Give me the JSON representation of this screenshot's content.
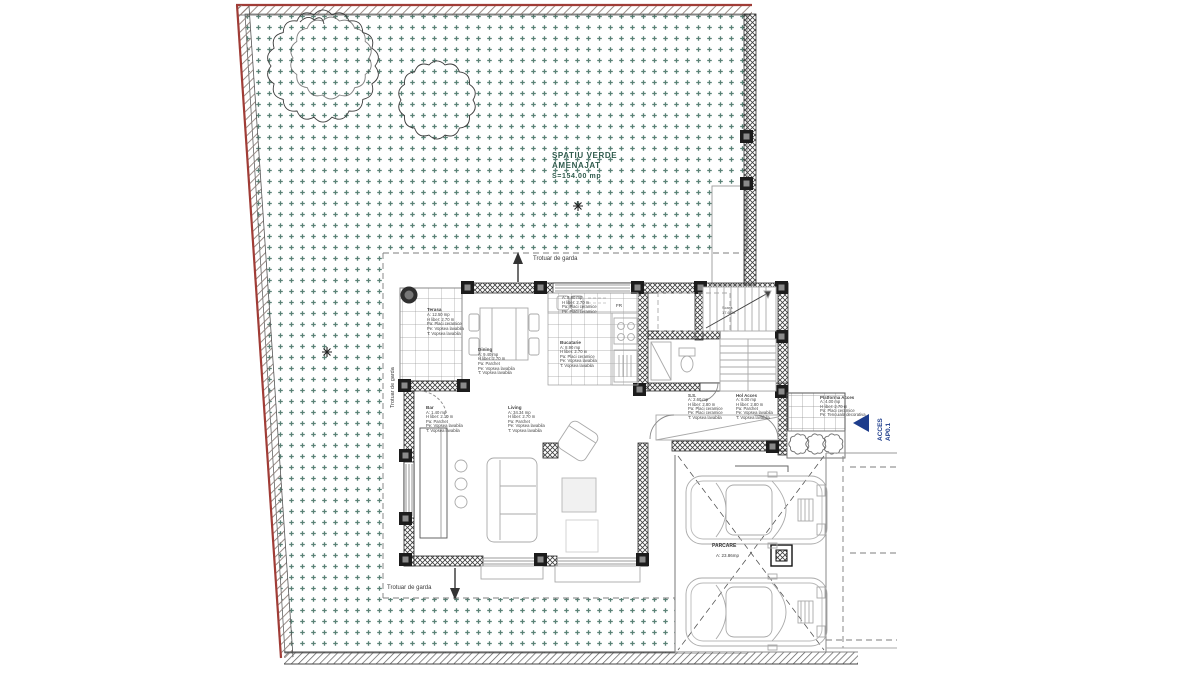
{
  "title": "Plan parter - amenajare incinta",
  "colors": {
    "stipple": "#3c6b5d",
    "boundary_red": "#a03c36",
    "hatch": "#8a7a74",
    "hatch_dark": "#5a5a5a",
    "wall_ink": "#2b2b2b",
    "tile": "#9b9b9b",
    "furn": "#a9a9a9",
    "accent_blue": "#1e3d8c",
    "text_dark": "#3b3b3b",
    "text_green": "#2f5a4c",
    "dash": "#7d7d7d"
  },
  "labels": {
    "green_area": {
      "lines": [
        "SPATIU VERDE",
        "AMENAJAT",
        "S=154.00 mp"
      ]
    },
    "sidewalk_top": "Trotuar de garda",
    "sidewalk_bottom": "Trotuar de garda",
    "sidewalk_west": "Trotuar de garda",
    "acces": {
      "lines": [
        "ACCES",
        "AP0.1"
      ]
    },
    "parcare": {
      "name": "PARCARE",
      "area": "A: 23.86mp"
    },
    "fr": "FR",
    "scara": {
      "lines": [
        "Scara",
        "17.6/28"
      ]
    },
    "terasa": {
      "lines": [
        "Terasa",
        "A: 12.50 mp",
        "H liber: 2.70 m",
        "Pa: Placi ceramice",
        "Pe: Vopsea lavabila",
        "T: Vopsea lavabila"
      ]
    },
    "dining": {
      "lines": [
        "Dining",
        "A: 9.40 mp",
        "H liber: 2.70 m",
        "Pa: Parchet",
        "Pe: Vopsea lavabila",
        "T: Vopsea lavabila"
      ]
    },
    "bucatarie_note": {
      "lines": [
        "A: 8.90 mp",
        "H liber: 2.70 m",
        "Pa: Placi ceramice",
        "Pe: Placi ceramice"
      ]
    },
    "bucatarie": {
      "lines": [
        "Bucatarie",
        "A: 8.90 mp",
        "H liber: 2.70 m",
        "Pa: Placi ceramice",
        "Pe: Vopsea lavabila",
        "T: Vopsea lavabila"
      ]
    },
    "bar": {
      "lines": [
        "Bar",
        "A: 1.40 mp",
        "H liber: 2.10 m",
        "Pa: Parchet",
        "Pe: Vopsea lavabila",
        "T: Vopsea lavabila"
      ]
    },
    "living": {
      "lines": [
        "Living",
        "A: 34.34 mp",
        "H liber: 2.70 m",
        "Pa: Parchet",
        "Pe: Vopsea lavabila",
        "T: Vopsea lavabila"
      ]
    },
    "ss": {
      "lines": [
        "S.S.",
        "A: 2.60 mp",
        "H liber: 2.80 m",
        "Pa: Placi ceramice",
        "Pe: Placi ceramice",
        "T: Vopsea lavabila"
      ]
    },
    "hol": {
      "lines": [
        "Hol Acces",
        "A: 6.00 mp",
        "H liber: 2.80 m",
        "Pa: Parchet",
        "Pe: Vopsea lavabila",
        "T: Vopsea lavabila"
      ]
    },
    "platforma": {
      "lines": [
        "Platforma Acces",
        "A: 4.00 mp",
        "H liber: 2.70 m",
        "Pa: Placi ceramice",
        "Pe: Tencuiala decorativa"
      ]
    }
  }
}
